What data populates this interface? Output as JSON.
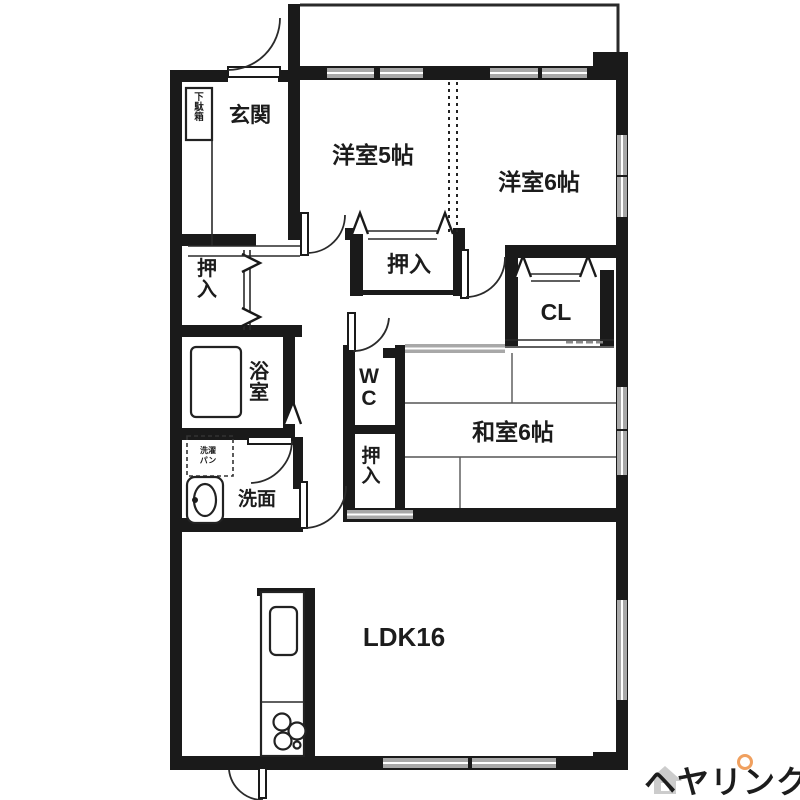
{
  "plan": {
    "labels": {
      "genkan": "玄関",
      "getabako": "下駄箱",
      "hall_closet": "押入",
      "bath": "浴室",
      "laundry_line1": "洗濯",
      "laundry_line2": "パン",
      "washroom": "洗面",
      "wc": "WC",
      "wc_closet": "押入",
      "west_room5": "洋室5帖",
      "west_room5_closet": "押入",
      "west_room6": "洋室6帖",
      "closet_cl": "CL",
      "japanese_room": "和室6帖",
      "ldk": "LDK16"
    },
    "colors": {
      "wall": "#1a1a1a",
      "window_gray": "#a8a8a8",
      "tatami_line": "#555555"
    }
  },
  "logo": {
    "text": "ヘヤリンク",
    "color": "#f0a05f"
  }
}
